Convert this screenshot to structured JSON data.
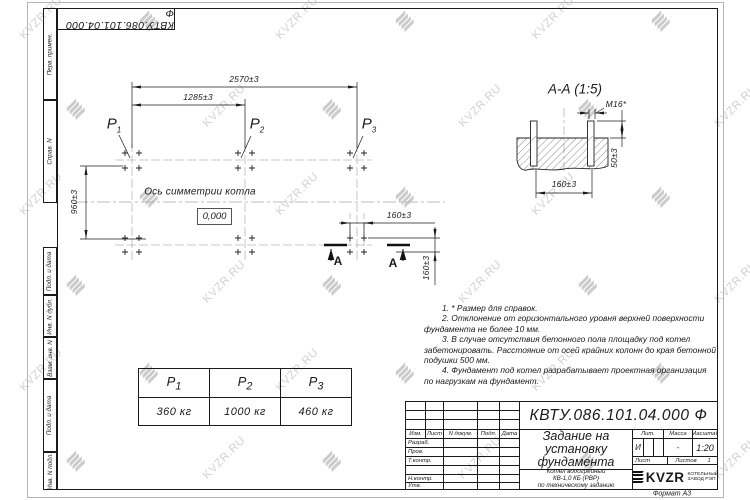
{
  "designation": "КВТУ.086.101.04.000 Ф",
  "watermark": {
    "text": "KVZR.RU",
    "color": "#d2d2d2"
  },
  "side_strip": {
    "labels": [
      "Перв. примен.",
      "Справ. N",
      "Подп. и дата",
      "Инв. N дубл.",
      "Взам. инв. N",
      "Подп. и дата",
      "Инв. N подл."
    ]
  },
  "plan": {
    "dim_total": "2570±3",
    "dim_half": "1285±3",
    "dim_depth": "960±3",
    "dim_bolt_spacing": "160±3",
    "dim_bolt_spacing_v": "160±3",
    "axis_label": "Ось симметрии котла",
    "level_mark": "0,000",
    "section_letter_left": "А",
    "section_letter_right": "А",
    "loads": [
      {
        "name": "P",
        "sub": "1"
      },
      {
        "name": "P",
        "sub": "2"
      },
      {
        "name": "P",
        "sub": "3"
      }
    ]
  },
  "section": {
    "title": "А-А (1:5)",
    "thread_label": "М16*",
    "dim_spacing": "160±3",
    "dim_height": "50±3"
  },
  "load_table": {
    "headers": [
      {
        "name": "P",
        "sub": "1"
      },
      {
        "name": "P",
        "sub": "2"
      },
      {
        "name": "P",
        "sub": "3"
      }
    ],
    "values": [
      "360 кг",
      "1000 кг",
      "460 кг"
    ]
  },
  "notes": [
    "1. * Размер для справок.",
    "2. Отклонение от горизонтального уровня верхней поверхности",
    "фундамента не более 10 мм.",
    "3. В случае отсутствия бетонного пола площадку под котел",
    "забетонировать. Расстояние от осей крайних колонн до края бетонной",
    "подушки 500 мм.",
    "4. Фундамент под котел разрабатывает проектная организация",
    "по нагрузкам на фундамент.",
    "10 мм",
    "500 мм"
  ],
  "title_block": {
    "designation": "КВТУ.086.101.04.000 Ф",
    "doc_title_lines": [
      "Задание на",
      "установку",
      "фундамента"
    ],
    "product_lines": [
      "Котел водогрейный",
      "КВ-1,0 КБ (РВР)",
      "по техническому заданию"
    ],
    "header_cols": [
      "Изм.",
      "Лист",
      "N докум.",
      "Подп.",
      "Дата"
    ],
    "sign_rows": [
      "Разраб.",
      "Пров.",
      "Т.контр.",
      "",
      "Н.контр.",
      "Утв."
    ],
    "lit_label": "Лит.",
    "mass_label": "Масса",
    "scale_label": "Масштаб",
    "lit_value": "И",
    "mass_value": "-",
    "scale_value": "1:20",
    "sheet_label": "Лист",
    "sheets_label": "Листов",
    "sheets_value": "1",
    "logo_text": "KVZR",
    "company_lines": [
      "КОТЕЛЬНЫЙ",
      "ЗАВОД РЭП"
    ],
    "format_label": "Формат А3"
  }
}
